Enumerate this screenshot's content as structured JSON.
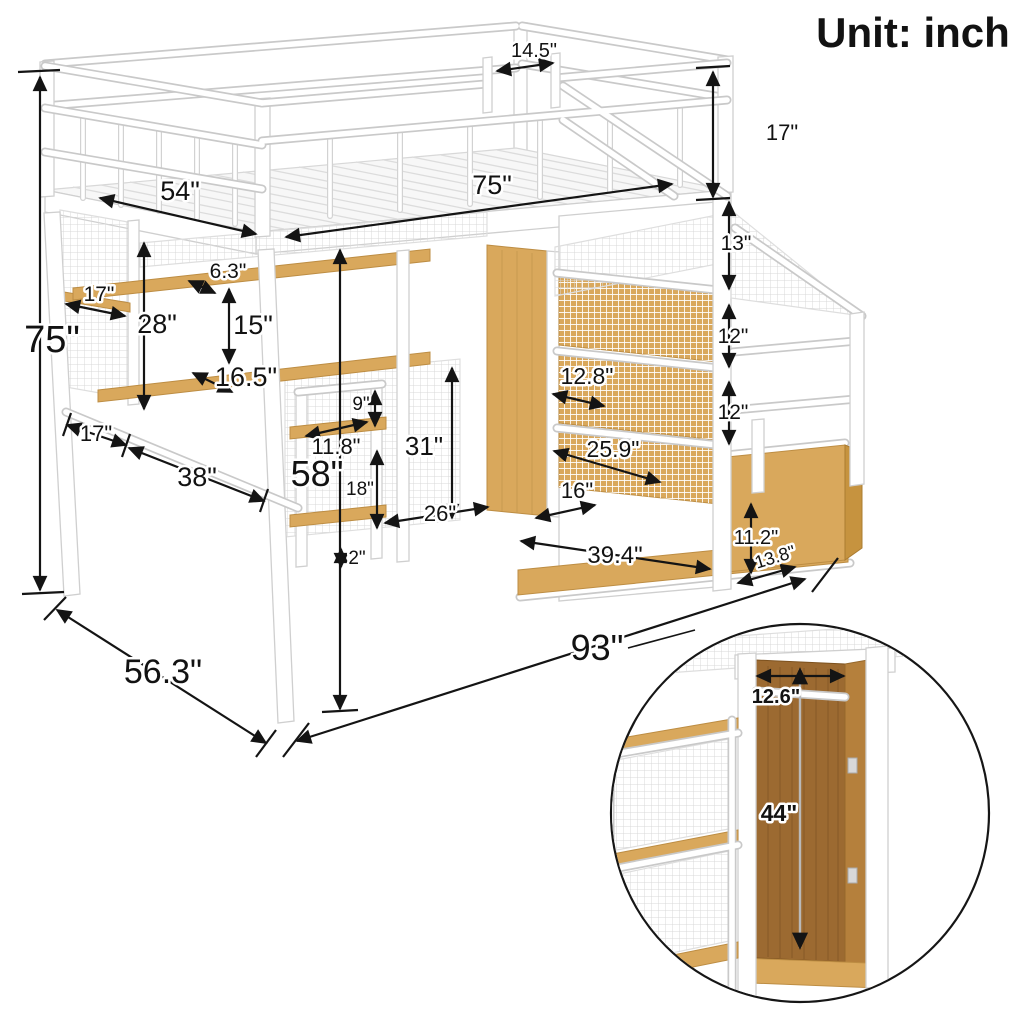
{
  "header": {
    "unit_label": "Unit: inch"
  },
  "dims": {
    "opening_width": "14.5\"",
    "guardrail_height": "17\"",
    "overall_height": "75\"",
    "bed_width": "54\"",
    "bed_length": "75\"",
    "stair_rise_top": "13\"",
    "stair_rise_mid": "12\"",
    "stair_rise_bottom": "12\"",
    "upper_shelf_depth": "6.3\"",
    "side_shelf_length": "17\"",
    "shelf_to_desk_height": "28\"",
    "shelf_gap_height": "15\"",
    "lower_shelf_depth": "16.5\"",
    "tower_top_gap": "9\"",
    "tower_shelf_width": "11.8\"",
    "front_leg_inset": "17\"",
    "desk_length": "38\"",
    "underbed_clearance": "58\"",
    "tower_shelf_gap": "18\"",
    "wardrobe_front_height": "31\"",
    "wardrobe_floor_depth": "26\"",
    "tower_foot_height": "2\"",
    "cubby_width_upper": "12.8\"",
    "cubby_width_lower": "25.9\"",
    "base_cubby_width": "16\"",
    "storage_base_length": "39.4\"",
    "bottom_step_height": "11.2\"",
    "bottom_step_depth": "13.8\"",
    "overall_length": "93\"",
    "overall_depth": "56.3\""
  },
  "inset": {
    "rod_width": "12.6\"",
    "interior_height": "44\""
  }
}
